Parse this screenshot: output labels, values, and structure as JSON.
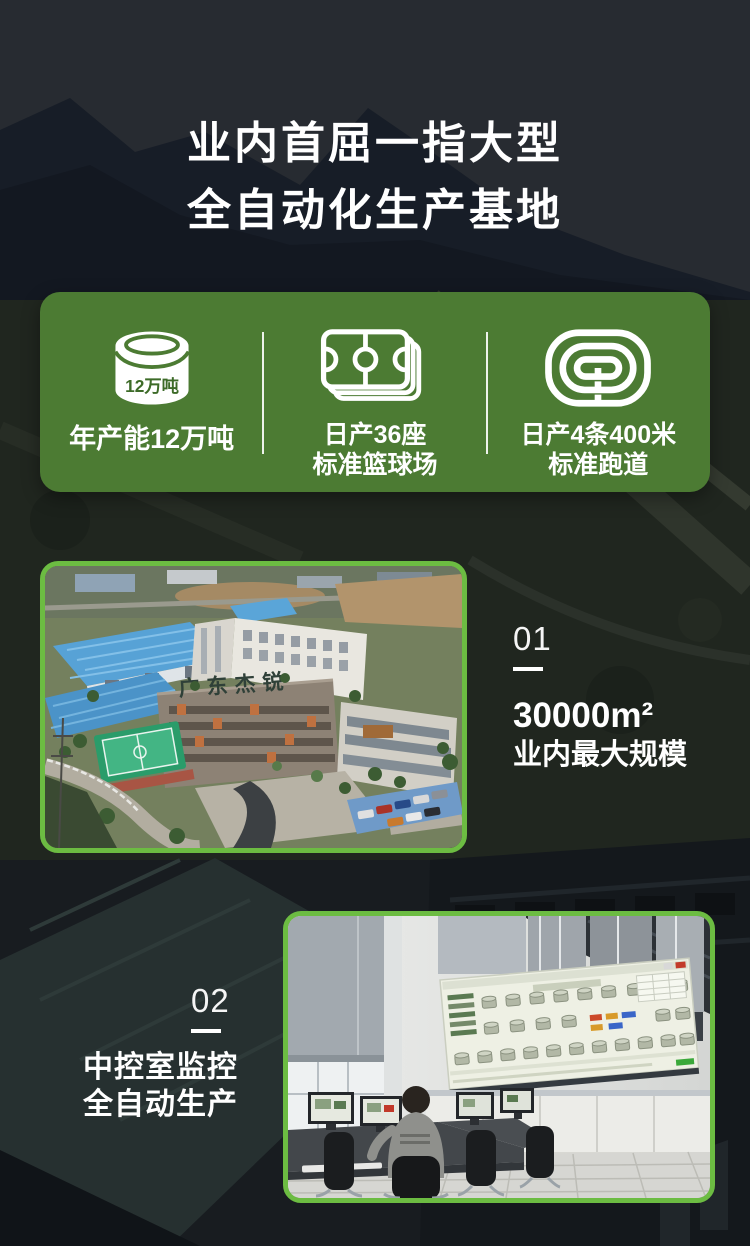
{
  "header": {
    "title_line1": "业内首屈一指大型",
    "title_line2": "全自动化生产基地"
  },
  "stats_card": {
    "items": [
      {
        "icon": "production-tank-icon",
        "badge": "12万吨",
        "lines": [
          "年产能12万吨",
          ""
        ]
      },
      {
        "icon": "basketball-court-icon",
        "lines": [
          "日产36座",
          "标准篮球场"
        ]
      },
      {
        "icon": "running-track-icon",
        "lines": [
          "日产4条400米",
          "标准跑道"
        ]
      }
    ]
  },
  "sections": [
    {
      "number": "01",
      "lines": [
        "30000m²",
        "业内最大规模"
      ],
      "photo_sign": "广东杰锐"
    },
    {
      "number": "02",
      "lines": [
        "中控室监控",
        "全自动生产"
      ]
    }
  ],
  "colors": {
    "card_green": "#4c7b33",
    "photo_border_green": "#6cbc42",
    "text_white": "#ffffff",
    "tank_badge_green": "#3d6b28"
  }
}
